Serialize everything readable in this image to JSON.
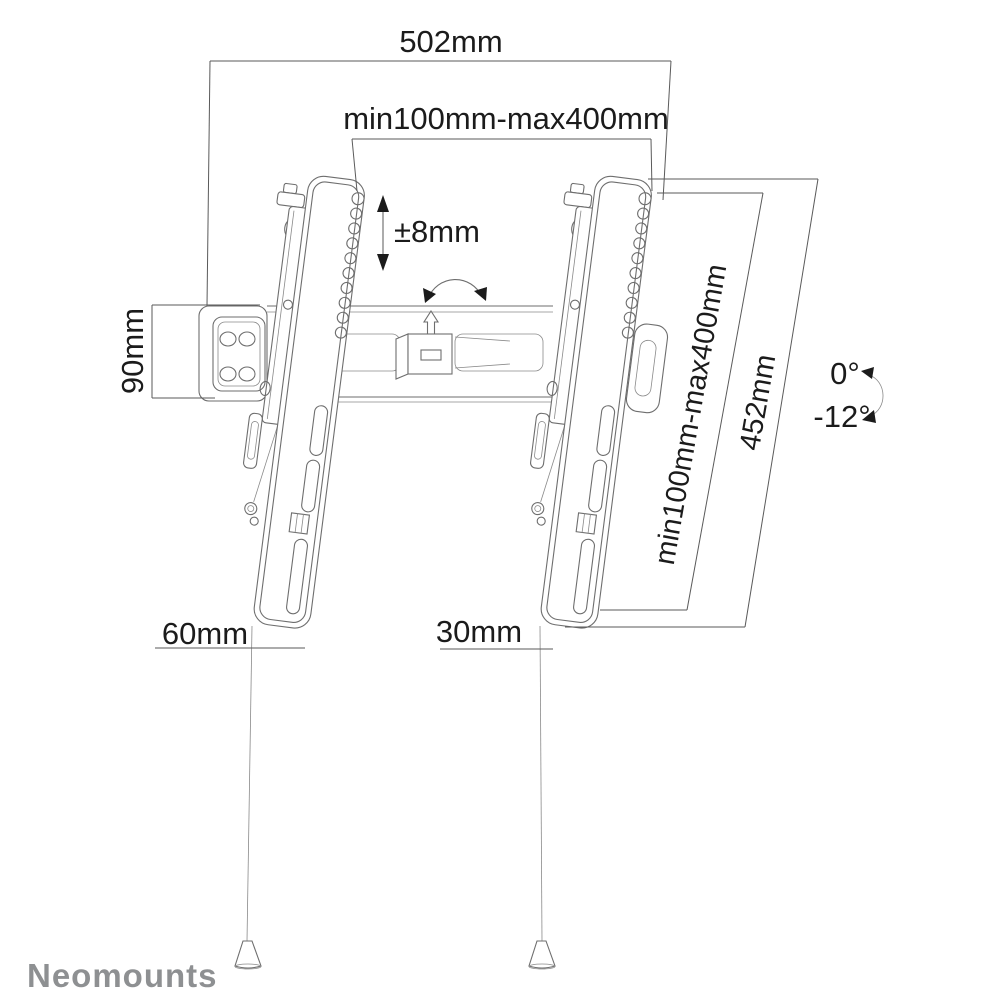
{
  "product": "tilting TV wall mount technical drawing",
  "colors": {
    "background": "#ffffff",
    "drawing_line": "#6e6e6e",
    "dimension_line": "#5a5a5a",
    "label_text": "#1b1b1b",
    "logo_gray": "#8e9092"
  },
  "labels": {
    "top_width": "502mm",
    "vesa_horizontal": "min100mm-max400mm",
    "height_adjustment": "±8mm",
    "wall_plate_height": "90mm",
    "vesa_vertical": "min100mm-max400mm",
    "bracket_length": "452mm",
    "tilt_max": "0°",
    "tilt_min": "-12°",
    "bottom_offset_left": "60mm",
    "bottom_offset_right": "30mm"
  },
  "brand": {
    "logo_text": "Neomounts"
  }
}
